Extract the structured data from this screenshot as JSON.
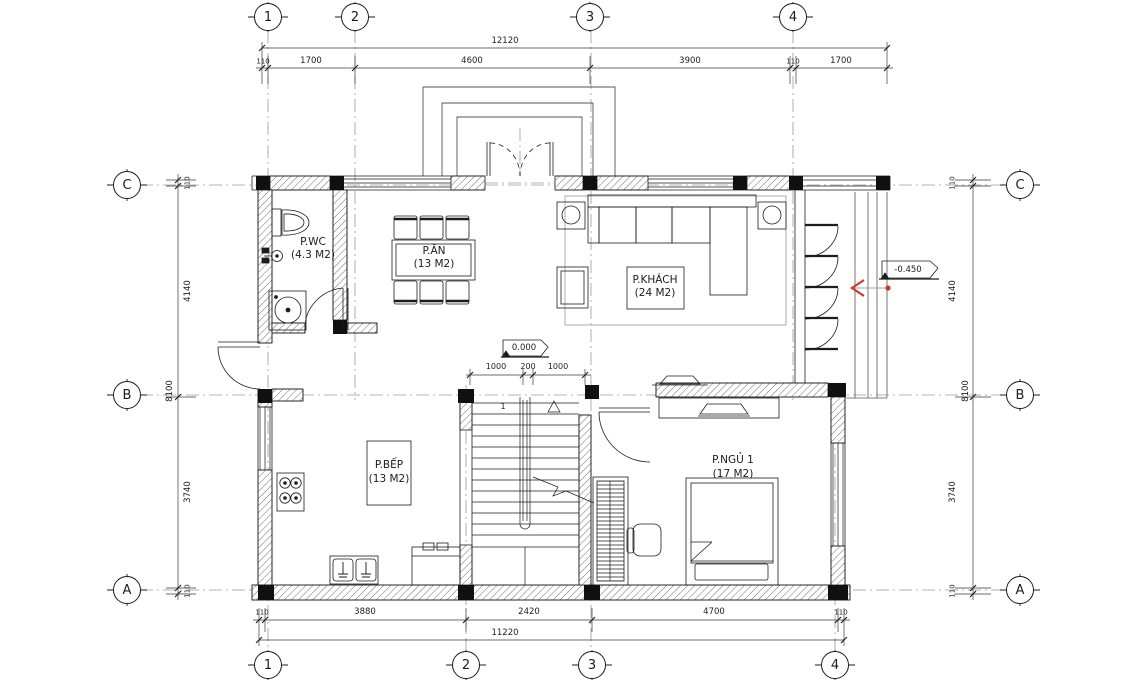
{
  "title": "floor-plan",
  "grid": {
    "top": [
      "1",
      "2",
      "3",
      "4"
    ],
    "bottom": [
      "1",
      "2",
      "3",
      "4"
    ],
    "left": [
      "C",
      "B",
      "A"
    ],
    "right": [
      "C",
      "B",
      "A"
    ]
  },
  "dims": {
    "top": {
      "total": "12120",
      "segments": [
        "110",
        "1700",
        "4600",
        "3900",
        "110",
        "1700"
      ]
    },
    "bottom": {
      "total": "11220",
      "segments": [
        "110",
        "3880",
        "2420",
        "4700",
        "110"
      ]
    },
    "left": {
      "total": "8100",
      "segments": [
        "110",
        "4140",
        "3740",
        "110"
      ]
    },
    "right": {
      "total": "8100",
      "segments": [
        "110",
        "4140",
        "3740",
        "110"
      ]
    },
    "stair": [
      "1000",
      "200",
      "1000"
    ]
  },
  "rooms": {
    "wc": {
      "name": "P.WC",
      "area": "(4.3 M2)"
    },
    "dining": {
      "name": "P.ĂN",
      "area": "(13 M2)"
    },
    "living": {
      "name": "P.KHÁCH",
      "area": "(24 M2)"
    },
    "kitchen": {
      "name": "P.BẾP",
      "area": "(13 M2)"
    },
    "bedroom": {
      "name": "P.NGỦ 1",
      "area": "(17 M2)"
    }
  },
  "levels": {
    "main": "0.000",
    "terrace": "-0.450"
  },
  "stairs": {
    "step_label": "1"
  },
  "colors": {
    "line": "#1c1c1c",
    "hatch": "#6f6f6f",
    "grid_line": "#9b9b9b",
    "accent_red": "#cb3a32"
  }
}
